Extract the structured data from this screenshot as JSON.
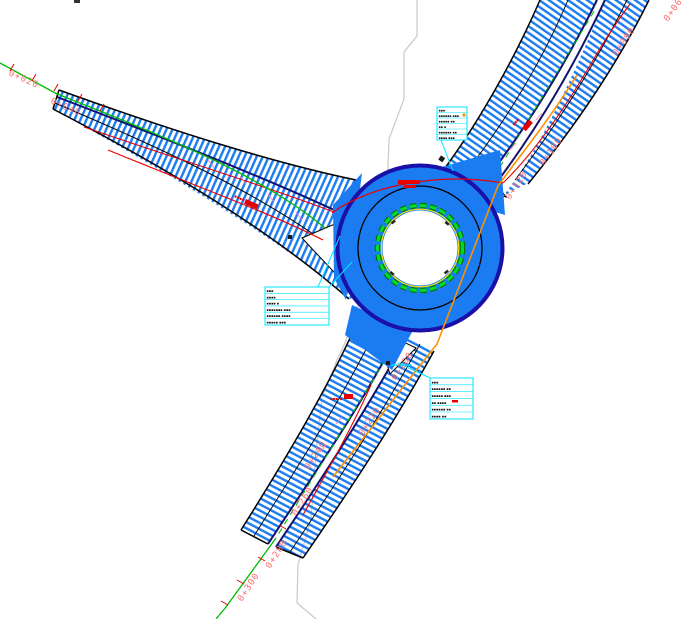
{
  "drawing": {
    "type": "roundabout-intersection-site-plan",
    "description": "CAD plan view of a 3-arm roundabout with chainage labels and annotation leaders"
  },
  "palette": {
    "road_hatch_blue": "#1b7cf2",
    "ring_fill_blue": "#1b7cf2",
    "ring_edge_navy": "#1a10a8",
    "carriageway_edge_navy": "#10126e",
    "centerline_green": "#00bb00",
    "apron_green": "#00cc33",
    "apron_yellow": "#ffe800",
    "station_red": "#ff6b6b",
    "marking_red": "#e80000",
    "existing_axis_orange": "#ff9000",
    "leader_cyan": "#00e5ff",
    "boundary_gray": "#c9c9c9",
    "slope_pink": "#ff7fbf"
  },
  "stations": [
    {
      "label": "0+020"
    },
    {
      "label": "0+040"
    },
    {
      "label": "0+060"
    },
    {
      "label": "0+080"
    },
    {
      "label": "0+100"
    },
    {
      "label": "0+120"
    },
    {
      "label": "0+200"
    },
    {
      "label": "0+220"
    },
    {
      "label": "0+240"
    },
    {
      "label": "0+260"
    },
    {
      "label": "0+280"
    },
    {
      "label": "0+300"
    }
  ],
  "annotation_boxes": [
    {
      "id": "box-top",
      "lines": [
        "▪▪▪",
        "▪▪▪▪▪▪ ▪▪▪",
        "▪▪▪▪▪ ▪▪",
        "▪▪ ▪",
        "▪▪▪▪▪▪ ▪▪",
        "▪▪▪▪ ▪▪▪"
      ]
    },
    {
      "id": "box-left",
      "lines": [
        "▪▪▪",
        "▪▪▪▪",
        "▪▪▪▪ ▪",
        "▪▪▪▪▪▪▪ ▪▪▪",
        "▪▪▪▪▪▪ ▪▪▪▪",
        "▪▪▪▪▪ ▪▪▪"
      ]
    },
    {
      "id": "box-bottom",
      "lines": [
        "▪▪▪",
        "▪▪▪▪▪▪ ▪▪",
        "▪▪▪▪▪ ▪▪▪",
        "▪▪ ▪▪▪▪",
        "▪▪▪▪▪▪ ▪▪",
        "▪▪▪▪ ▪▪"
      ]
    }
  ],
  "tiny_notes": [
    {
      "text": "▪▪▪ ▪▪▪▪▪"
    }
  ],
  "red_marks": [
    {
      "text": "▪▪▪▪"
    },
    {
      "text": "▪▪▪ ▪"
    },
    {
      "text": "▪▪▪"
    }
  ]
}
